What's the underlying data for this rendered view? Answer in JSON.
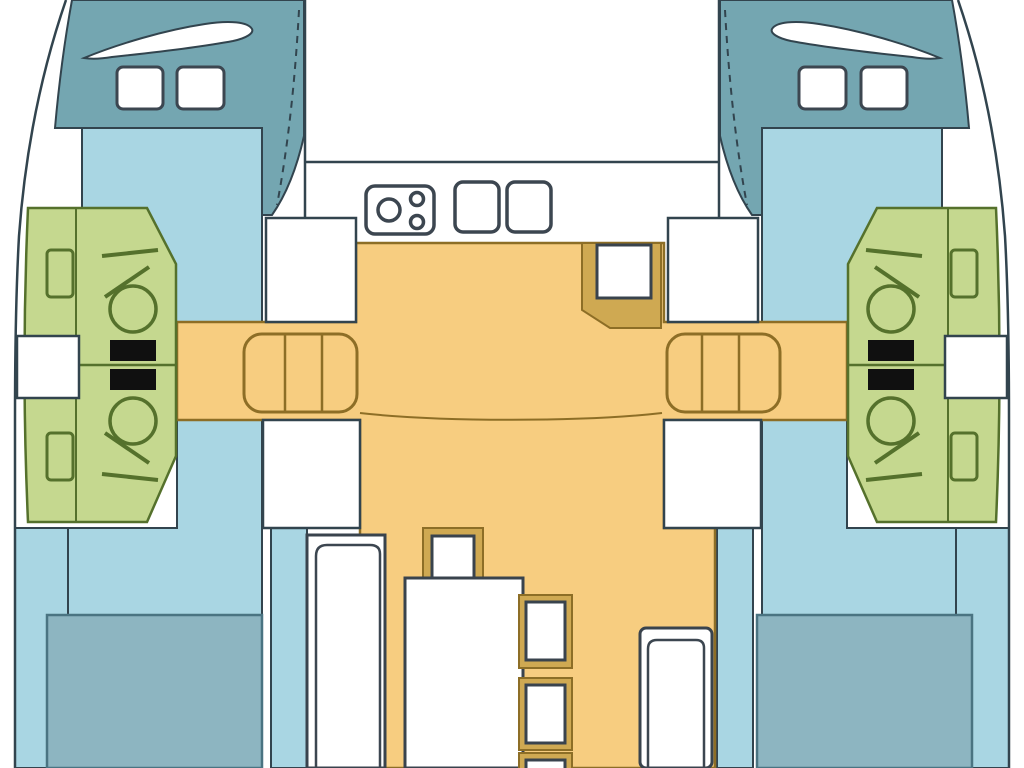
{
  "palette": {
    "background": "#ffffff",
    "outline": "#32444e",
    "bow_teal": "#74a6b1",
    "hull_blue": "#a9d6e3",
    "berth_blue": "#8db5c1",
    "berth_outline": "#4a7482",
    "bath_green": "#c5d88f",
    "bath_line": "#55712c",
    "floor_orange": "#f7cd80",
    "floor_line": "#8d6e26",
    "tan": "#cfa952",
    "furniture_outline": "#39434d",
    "fixture_outline": "#3c4650",
    "toilet_tank": "#101010",
    "white": "#ffffff"
  },
  "diagram": {
    "type": "catamaran-deck-plan",
    "orientation": "bows-at-top",
    "rooms": [
      "bow-deck-port",
      "bow-deck-starboard",
      "fore-cabin-port",
      "fore-cabin-starboard",
      "bathroom-port",
      "bathroom-starboard",
      "foredeck-center",
      "galley-counter",
      "saloon-floor",
      "bridge-seating",
      "dinette",
      "aft-cabin-port",
      "aft-cabin-starboard"
    ],
    "fixture_icons": [
      "stove-icon",
      "sink-icon",
      "toilet-icon",
      "shower-icon",
      "washbasin-icon",
      "deck-hatch-icon",
      "settee-icon",
      "table-icon",
      "stool-icon",
      "berth-icon"
    ]
  }
}
